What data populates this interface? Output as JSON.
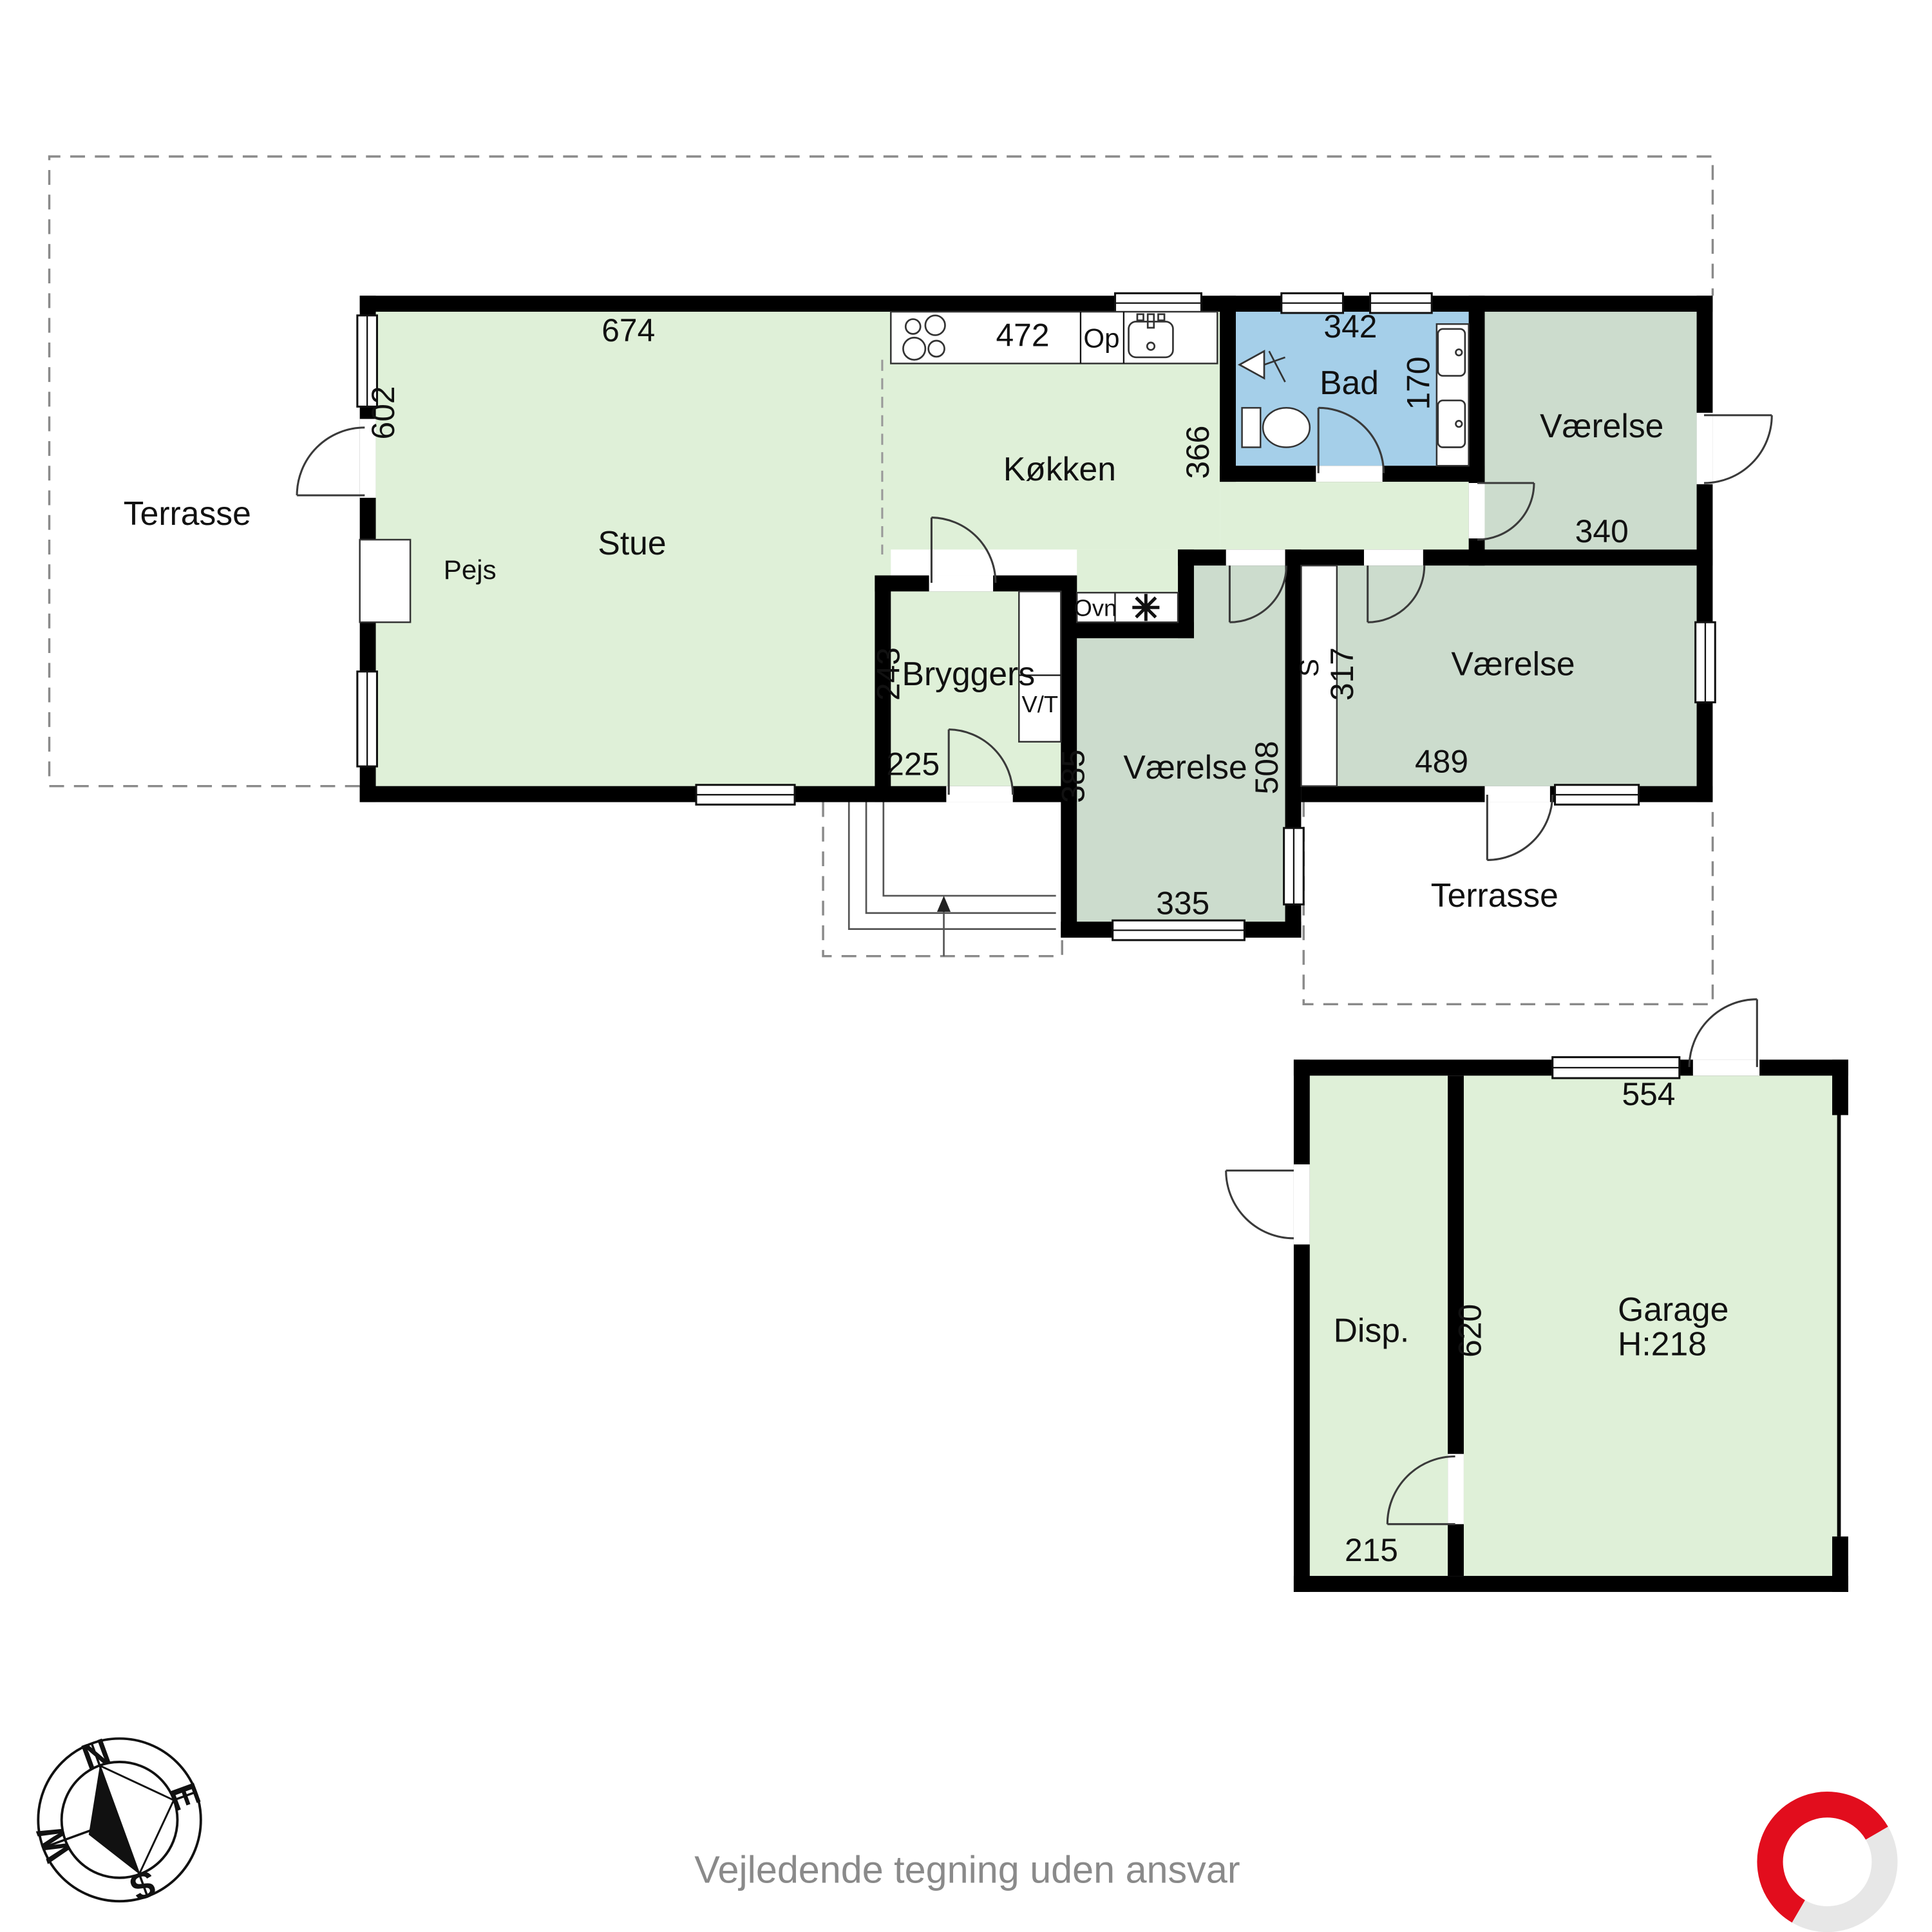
{
  "footer": {
    "disclaimer": "Vejledende tegning uden ansvar"
  },
  "compass": {
    "n": "N",
    "e": "E",
    "s": "S",
    "w": "W"
  },
  "colors": {
    "floor_light_green": "#dff0d8",
    "floor_room_green": "#ccdccd",
    "floor_bath_blue": "#a5cfe9",
    "wall_black": "#000000",
    "logo_red": "#e20d1d",
    "logo_gray": "#e7e7e7",
    "dashed_gray": "#8a8a8a",
    "footer_gray": "#8a8a8a"
  },
  "plan": {
    "rooms": {
      "stue": {
        "label": "Stue",
        "width": "674",
        "height": "602"
      },
      "kokken": {
        "label": "Køkken",
        "width": "472",
        "height": "366"
      },
      "bad": {
        "label": "Bad",
        "width": "342",
        "height": "170"
      },
      "vaerelse_ne": {
        "label": "Værelse",
        "width": "340"
      },
      "vaerelse_mid": {
        "label": "Værelse",
        "width": "335",
        "height_left": "385",
        "height_right": "508"
      },
      "vaerelse_e": {
        "label": "Værelse",
        "width": "489",
        "height": "317"
      },
      "bryggers": {
        "label": "Bryggers",
        "height": "243",
        "width": "225"
      },
      "terrasse_nw": {
        "label": "Terrasse"
      },
      "terrasse_se": {
        "label": "Terrasse"
      },
      "disp": {
        "label": "Disp.",
        "width": "215"
      },
      "garage": {
        "label": "Garage",
        "height_note": "H:218",
        "width": "554",
        "depth": "620"
      }
    },
    "features": {
      "pejs": "Pejs",
      "ovn": "Ovn",
      "op": "Op",
      "vt": "V/T",
      "skab": "S"
    }
  }
}
